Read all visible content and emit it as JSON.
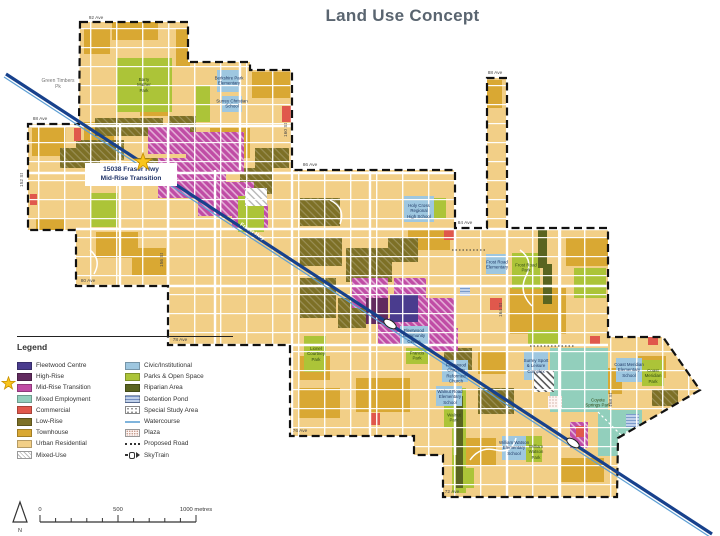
{
  "title": "Land Use Concept",
  "callout": {
    "text": "15038 Fraser Hwy\nMid-Rise Transition"
  },
  "legend": {
    "heading": "Legend",
    "left": [
      {
        "label": "Fleetwood Centre",
        "kind": "solid",
        "color": "#4A3C8E"
      },
      {
        "label": "High-Rise",
        "kind": "solid",
        "color": "#622B5F"
      },
      {
        "label": "Mid-Rise Transition",
        "kind": "solid",
        "color": "#C04CA5",
        "star": true
      },
      {
        "label": "Mixed Employment",
        "kind": "solid",
        "color": "#92CFBC"
      },
      {
        "label": "Commercial",
        "kind": "solid",
        "color": "#E0584C"
      },
      {
        "label": "Low-Rise",
        "kind": "solid",
        "color": "#7D7026"
      },
      {
        "label": "Townhouse",
        "kind": "solid",
        "color": "#D9A833"
      },
      {
        "label": "Urban Residential",
        "kind": "solid",
        "color": "#F2CF87"
      },
      {
        "label": "Mixed-Use",
        "kind": "mixeduse",
        "color": "#FFFFFF"
      }
    ],
    "right": [
      {
        "label": "Civic/Institutional",
        "kind": "solid",
        "color": "#9EC7E0"
      },
      {
        "label": "Parks & Open Space",
        "kind": "solid",
        "color": "#ACC438"
      },
      {
        "label": "Riparian Area",
        "kind": "solid",
        "color": "#5A6420"
      },
      {
        "label": "Detention Pond",
        "kind": "pond",
        "color": "#BFD0EA"
      },
      {
        "label": "Special Study Area",
        "kind": "study",
        "color": "#FFFFFF"
      },
      {
        "label": "Watercourse",
        "kind": "wline",
        "color": "#7FB4DC"
      },
      {
        "label": "Plaza",
        "kind": "plaza",
        "color": "#FDF4F2"
      },
      {
        "label": "Proposed Road",
        "kind": "dotline",
        "color": "#333333"
      },
      {
        "label": "SkyTrain",
        "kind": "skytrain",
        "color": "#333333"
      }
    ]
  },
  "scalebar": {
    "start": "0",
    "mid": "500",
    "end": "1000 metres",
    "north": "N"
  },
  "map": {
    "street_labels": [
      {
        "t": "92 Ave",
        "x": 96,
        "y": 19
      },
      {
        "t": "88 Ave",
        "x": 40,
        "y": 120
      },
      {
        "t": "88 Ave",
        "x": 495,
        "y": 74
      },
      {
        "t": "86 Ave",
        "x": 310,
        "y": 166
      },
      {
        "t": "84 Ave",
        "x": 465,
        "y": 224
      },
      {
        "t": "80 Ave",
        "x": 88,
        "y": 282
      },
      {
        "t": "78 Ave",
        "x": 180,
        "y": 341
      },
      {
        "t": "76 Ave",
        "x": 300,
        "y": 432
      },
      {
        "t": "72 Ave",
        "x": 452,
        "y": 493
      },
      {
        "t": "152 St",
        "x": 23,
        "y": 180,
        "rot": -90
      },
      {
        "t": "156 St",
        "x": 163,
        "y": 260,
        "rot": -90
      },
      {
        "t": "160 St",
        "x": 287,
        "y": 130,
        "rot": -90
      },
      {
        "t": "164 St",
        "x": 502,
        "y": 310,
        "rot": -90
      },
      {
        "t": "168 St",
        "x": 612,
        "y": 400,
        "rot": -90
      }
    ],
    "poi_labels": [
      {
        "t": "Green Timbers\nPk",
        "x": 58,
        "y": 84,
        "c": "gray"
      },
      {
        "t": "Barry\nMather\nPark",
        "x": 144,
        "y": 85,
        "c": "park"
      },
      {
        "t": "Berkshire Park\nElementary",
        "x": 229,
        "y": 81,
        "c": "civic"
      },
      {
        "t": "Surrey Christian\nSchool",
        "x": 232,
        "y": 104,
        "c": "civic"
      },
      {
        "t": "Holy Cross\nRegional\nHigh School",
        "x": 419,
        "y": 211,
        "c": "civic"
      },
      {
        "t": "Frost Road\nElementary",
        "x": 497,
        "y": 265,
        "c": "civic"
      },
      {
        "t": "Frost Road\nPark",
        "x": 526,
        "y": 268,
        "c": "park"
      },
      {
        "t": "Fleetwood\nCommunity\nCentre",
        "x": 414,
        "y": 336,
        "c": "civic"
      },
      {
        "t": "Francis\nPark",
        "x": 417,
        "y": 356,
        "c": "park"
      },
      {
        "t": "Lionel\nCourtney\nPark",
        "x": 316,
        "y": 354,
        "c": "park"
      },
      {
        "t": "Fleetwood\nChristian\nReformed\nChurch",
        "x": 456,
        "y": 373,
        "c": "civic"
      },
      {
        "t": "Walnut Road\nElementary\nSchool",
        "x": 450,
        "y": 397,
        "c": "civic"
      },
      {
        "t": "Walnut\nPark",
        "x": 454,
        "y": 418,
        "c": "park"
      },
      {
        "t": "Surrey Sport\n& Leisure\nComplex",
        "x": 536,
        "y": 366,
        "c": "civic"
      },
      {
        "t": "Coast Meridian\nElementary\nSchool",
        "x": 629,
        "y": 370,
        "c": "civic"
      },
      {
        "t": "Coast\nMeridian\nPark",
        "x": 653,
        "y": 376,
        "c": "park"
      },
      {
        "t": "William Watson\nElementary\nSchool",
        "x": 514,
        "y": 448,
        "c": "civic"
      },
      {
        "t": "William\nWatson\nPark",
        "x": 536,
        "y": 452,
        "c": "park"
      },
      {
        "t": "Coyote\nSprings Park",
        "x": 598,
        "y": 403,
        "c": "park"
      },
      {
        "t": "Fraser Hwy",
        "x": 252,
        "y": 232,
        "c": "hwy",
        "rot": 33
      }
    ]
  },
  "palette": {
    "urban_residential": "#F2CF87",
    "townhouse": "#D9A833",
    "low_rise": "#7D7026",
    "parks": "#ACC438",
    "riparian": "#5A6420",
    "civic": "#9EC7E0",
    "commercial": "#E0584C",
    "mid_rise": "#C04CA5",
    "fleetwood_centre": "#4A3C8E",
    "high_rise": "#622B5F",
    "mixed_employment": "#92CFBC",
    "detention_pond": "#BFD0EA",
    "skytrain_line": "#17418C",
    "watercourse": "#7FB4DC",
    "title_text": "#5A6570",
    "star": "#F9C51C"
  }
}
